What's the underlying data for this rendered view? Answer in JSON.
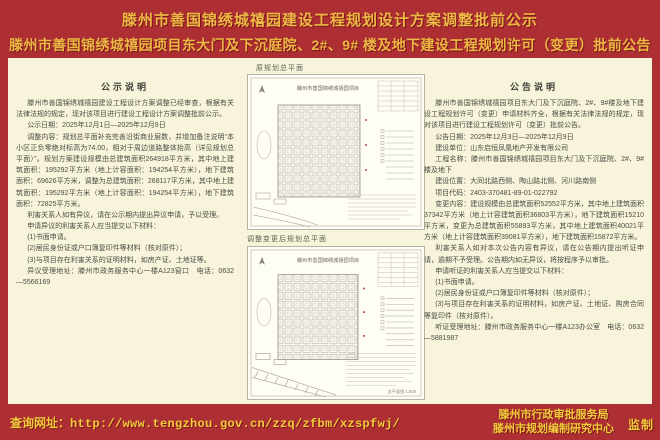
{
  "header": {
    "title_line1": "滕州市善国锦绣城禧园建设工程规划设计方案调整批前公示",
    "title_line2": "滕州市善国锦绣城禧园项目东大门及下沉庭院、2#、9# 楼及地下建设工程规划许可（变更）批前公告"
  },
  "left_notice": {
    "heading": "公示说明",
    "paragraphs": [
      "滕州市善国锦绣城禧园建设工程设计方案调整已经审查，根据有关法律法规的规定，现对该项目进行建设工程设计方案调整批前公示。",
      "公示日期：2025年12月1日—2025年12月9日",
      "调整内容：规划总平面补充完善沿街商业层数，并增加备注说明“本小区正负零绝对标高为74.00，相对于周边道路整体抬高（详见规划总平面）”。规划方案建设规模由总建筑面积264918平方米，其中地上建筑面积：195292平方米（地上计容面积：194254平方米），地下建筑面积：69626平方米，调整为总建筑面积：268117平方米，其中地上建筑面积：195292平方米（地上计容面积：194254平方米），地下建筑面积：72825平方米。",
      "利害关系人如有异议，请在公示期内提出异议申请，予以受理。",
      "申请异议的利害关系人应当提交以下材料：",
      "(1)书面申请。",
      "(2)居民身份证或户口簿复印件等材料（核对原件）；",
      "(3)与项目存在利害关系的证明材料，如房产证、土地证等。",
      "异议受理地址：滕州市政务服务中心一楼A123窗口　电话：0632—5566169"
    ]
  },
  "plans": {
    "top_label": "原规划总平面",
    "bottom_label": "调整变更后规划总平面",
    "drawing_title": "滕州市善国锦绣城禧园项目",
    "scale_note": "总平面图 1:500"
  },
  "right_notice": {
    "heading": "公告说明",
    "paragraphs": [
      "滕州市善国锦绣城禧园项目东大门及下沉庭院、2#、9#楼及地下建设工程规划许可（变更）申请材料齐全，根据有关法律法规的规定，现对该项目进行建设工程规划许可（变更）批前公告。",
      "公告日期：2025年12月3日—2025年12月9日",
      "建设单位：山东启恒凤凰地产开发有限公司",
      "工程名称：滕州市善国锦绣城禧园项目东大门及下沉庭院、2#、9#楼及地下",
      "建设位置：大同北路西侧、陶山路北侧、河川路南侧",
      "项目代码：2403-370481-89-01-022792",
      "变更内容：建设规模由总建筑面积52552平方米，其中地上建筑面积37342平方米（地上计容建筑面积36803平方米），地下建筑面积15210平方米，变更为总建筑面积55893平方米，其中地上建筑面积40021平方米（地上计容建筑面积39081平方米），地下建筑面积15872平方米。",
      "利害关系人如对本次公告内容有异议，请在公告期内提出听证申请，逾期不予受理。公告期内如无异议，将按程序予以审批。",
      "申请听证的利害关系人应当提交以下材料：",
      "(1)书面申请。",
      "(2)居民身份证或户口簿复印件等材料（核对原件）；",
      "(3)与项目存在利害关系的证明材料，如房产证、土地证、购房合同等复印件（核对原件）。",
      "听证受理地址：滕州市政务服务中心一楼A123办公室　电话：0632—5881987"
    ]
  },
  "footer": {
    "query_label": "查询网址：",
    "query_url": "http://www.tengzhou.gov.cn/zzq/zfbm/xzspfwj/",
    "org_line1": "滕州市行政审批服务局",
    "org_line2": "滕州市规划编制研究中心",
    "seal": "监制"
  },
  "colors": {
    "background_red": "#ae2f33",
    "title_gold": "#edb845",
    "panel_cream": "#f8f4dc",
    "footer_yellow": "#f2cc3d",
    "body_text": "#4b4b42"
  }
}
